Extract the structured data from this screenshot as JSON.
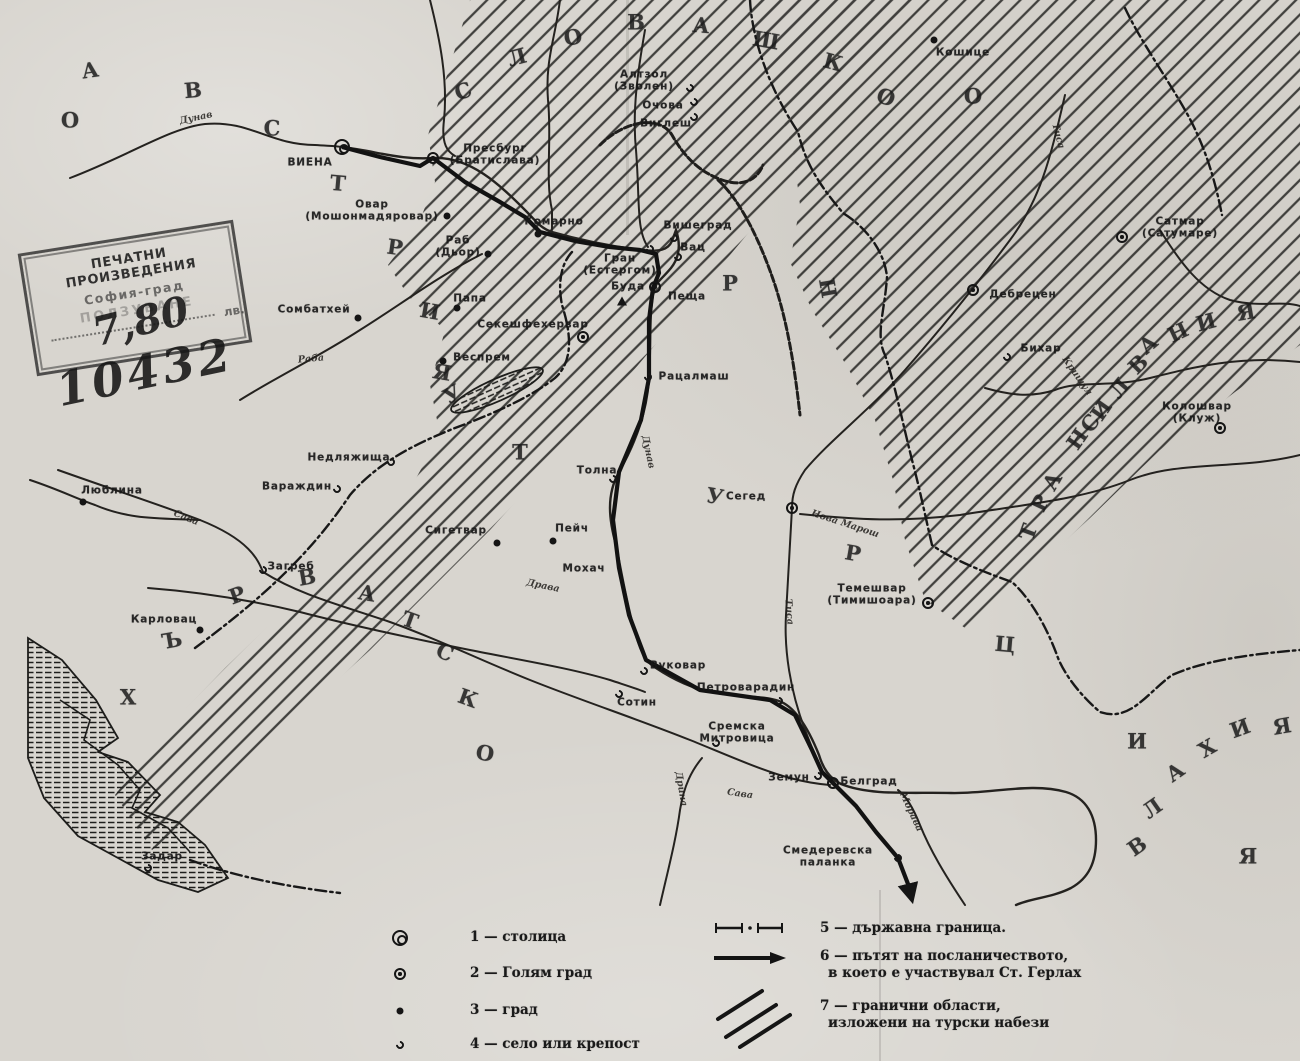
{
  "map": {
    "title_hint": "Historical map of Hungary and surrounding lands (Bulgarian, scanned)",
    "paper_color": "#d8d5cf",
    "ink_color": "#1b1b1b"
  },
  "stamp": {
    "line1": "ПЕЧАТНИ ПРОИЗВЕДЕНИЯ",
    "line2": "София-град",
    "line3": "ПОЛЗУВАНЕ",
    "currency": "лв.",
    "handwritten_price": "7,80",
    "handwritten_number": "10432"
  },
  "region_letters": [
    {
      "word": "австрия",
      "ch": "А",
      "x": 90,
      "y": 70,
      "r": -8
    },
    {
      "word": "австрия",
      "ch": "В",
      "x": 193,
      "y": 90,
      "r": -5
    },
    {
      "word": "австрия",
      "ch": "С",
      "x": 272,
      "y": 128,
      "r": 0
    },
    {
      "word": "австрия",
      "ch": "Т",
      "x": 338,
      "y": 183,
      "r": 5
    },
    {
      "word": "австрия",
      "ch": "Р",
      "x": 395,
      "y": 247,
      "r": 8
    },
    {
      "word": "австрия",
      "ch": "И",
      "x": 430,
      "y": 311,
      "r": 10
    },
    {
      "word": "австрия",
      "ch": "Я",
      "x": 442,
      "y": 372,
      "r": 10
    },
    {
      "word": "унгария",
      "ch": "У",
      "x": 452,
      "y": 394,
      "r": -30
    },
    {
      "word": "унгария",
      "ch": "Р",
      "x": 730,
      "y": 283,
      "r": 0
    },
    {
      "word": "унгария",
      "ch": "Н",
      "x": 828,
      "y": 288,
      "r": 80
    },
    {
      "word": "словашко",
      "ch": "С",
      "x": 463,
      "y": 91,
      "r": -20
    },
    {
      "word": "словашко",
      "ch": "Л",
      "x": 517,
      "y": 57,
      "r": -15
    },
    {
      "word": "словашко",
      "ch": "О",
      "x": 573,
      "y": 37,
      "r": -10
    },
    {
      "word": "словашко",
      "ch": "В",
      "x": 636,
      "y": 22,
      "r": 0
    },
    {
      "word": "словашко",
      "ch": "А",
      "x": 701,
      "y": 25,
      "r": 5
    },
    {
      "word": "словашко",
      "ch": "Ш",
      "x": 766,
      "y": 40,
      "r": 10
    },
    {
      "word": "словашко",
      "ch": "К",
      "x": 833,
      "y": 62,
      "r": 15
    },
    {
      "word": "словашко",
      "ch": "О",
      "x": 886,
      "y": 97,
      "r": 20
    },
    {
      "word": "словашко",
      "ch": "О",
      "x": 973,
      "y": 96,
      "r": 0
    },
    {
      "word": "мизия",
      "ch": "О",
      "x": 70,
      "y": 120,
      "r": 0
    },
    {
      "word": "турция",
      "ch": "Т",
      "x": 520,
      "y": 452,
      "r": 0
    },
    {
      "word": "турция",
      "ch": "У",
      "x": 715,
      "y": 496,
      "r": 10
    },
    {
      "word": "турция",
      "ch": "Р",
      "x": 853,
      "y": 553,
      "r": 10
    },
    {
      "word": "турция",
      "ch": "Ц",
      "x": 1005,
      "y": 644,
      "r": 5
    },
    {
      "word": "турция",
      "ch": "И",
      "x": 1137,
      "y": 741,
      "r": 0
    },
    {
      "word": "турция",
      "ch": "Я",
      "x": 1248,
      "y": 856,
      "r": 0
    },
    {
      "word": "трансилвания",
      "ch": "Т",
      "x": 1028,
      "y": 532,
      "r": -70
    },
    {
      "word": "трансилвания",
      "ch": "Р",
      "x": 1040,
      "y": 503,
      "r": -65
    },
    {
      "word": "трансилвания",
      "ch": "А",
      "x": 1052,
      "y": 481,
      "r": -60
    },
    {
      "word": "трансилвания",
      "ch": "Н",
      "x": 1077,
      "y": 439,
      "r": -55
    },
    {
      "word": "трансилвания",
      "ch": "С",
      "x": 1090,
      "y": 423,
      "r": -55
    },
    {
      "word": "трансилвания",
      "ch": "И",
      "x": 1101,
      "y": 410,
      "r": -55
    },
    {
      "word": "трансилвания",
      "ch": "Л",
      "x": 1119,
      "y": 388,
      "r": -50
    },
    {
      "word": "трансилвания",
      "ch": "В",
      "x": 1138,
      "y": 364,
      "r": -45
    },
    {
      "word": "трансилвания",
      "ch": "А",
      "x": 1148,
      "y": 344,
      "r": -40
    },
    {
      "word": "трансилвания",
      "ch": "Н",
      "x": 1178,
      "y": 332,
      "r": -25
    },
    {
      "word": "трансилвания",
      "ch": "И",
      "x": 1206,
      "y": 322,
      "r": -15
    },
    {
      "word": "трансилвания",
      "ch": "Я",
      "x": 1246,
      "y": 312,
      "r": -10
    },
    {
      "word": "хърватско",
      "ch": "Х",
      "x": 128,
      "y": 697,
      "r": 0
    },
    {
      "word": "хърватско",
      "ch": "Ъ",
      "x": 172,
      "y": 640,
      "r": -10
    },
    {
      "word": "хърватско",
      "ch": "Р",
      "x": 237,
      "y": 595,
      "r": -20
    },
    {
      "word": "хърватско",
      "ch": "В",
      "x": 307,
      "y": 577,
      "r": -10
    },
    {
      "word": "хърватско",
      "ch": "А",
      "x": 367,
      "y": 593,
      "r": 10
    },
    {
      "word": "хърватско",
      "ch": "Т",
      "x": 410,
      "y": 620,
      "r": 20
    },
    {
      "word": "хърватско",
      "ch": "С",
      "x": 445,
      "y": 652,
      "r": 25
    },
    {
      "word": "хърватско",
      "ch": "К",
      "x": 468,
      "y": 698,
      "r": 20
    },
    {
      "word": "хърватско",
      "ch": "О",
      "x": 485,
      "y": 753,
      "r": 10
    },
    {
      "word": "влахия",
      "ch": "В",
      "x": 1137,
      "y": 846,
      "r": -35
    },
    {
      "word": "влахия",
      "ch": "Л",
      "x": 1152,
      "y": 808,
      "r": -35
    },
    {
      "word": "влахия",
      "ch": "А",
      "x": 1175,
      "y": 772,
      "r": -35
    },
    {
      "word": "влахия",
      "ch": "Х",
      "x": 1207,
      "y": 748,
      "r": -30
    },
    {
      "word": "влахия",
      "ch": "И",
      "x": 1240,
      "y": 728,
      "r": -20
    },
    {
      "word": "влахия",
      "ch": "Я",
      "x": 1282,
      "y": 726,
      "r": -10
    }
  ],
  "cities": [
    {
      "label": [
        "ВИЕНА"
      ],
      "lx": 310,
      "ly": 163,
      "symbol": "capital",
      "sx": 342,
      "sy": 147
    },
    {
      "label": [
        "Пресбург",
        "(Братислава)"
      ],
      "lx": 495,
      "ly": 149,
      "symbol": "big",
      "sx": 433,
      "sy": 158
    },
    {
      "label": [
        "Овар",
        "(Мошонмадяровар)"
      ],
      "lx": 372,
      "ly": 205,
      "symbol": "town",
      "sx": 447,
      "sy": 216
    },
    {
      "label": [
        "Раб",
        "(Дьор)"
      ],
      "lx": 458,
      "ly": 241,
      "symbol": "town",
      "sx": 488,
      "sy": 254
    },
    {
      "label": [
        "Комарно"
      ],
      "lx": 554,
      "ly": 222,
      "symbol": "town",
      "sx": 538,
      "sy": 234
    },
    {
      "label": [
        "Гран",
        "(Естергом)"
      ],
      "lx": 620,
      "ly": 259,
      "symbol": "village",
      "sx": 650,
      "sy": 249
    },
    {
      "label": [
        "Вишеград"
      ],
      "lx": 698,
      "ly": 226,
      "symbol": "village",
      "sx": 674,
      "sy": 238
    },
    {
      "label": [
        "Вац"
      ],
      "lx": 693,
      "ly": 248,
      "symbol": "village",
      "sx": 678,
      "sy": 257
    },
    {
      "label": [
        "Буда"
      ],
      "lx": 628,
      "ly": 287,
      "symbol": "big",
      "sx": 655,
      "sy": 287
    },
    {
      "label": [
        "Пеща"
      ],
      "lx": 687,
      "ly": 297,
      "symbol": "triangle",
      "sx": 622,
      "sy": 301
    },
    {
      "label": [
        "Секешфехервар"
      ],
      "lx": 533,
      "ly": 325,
      "symbol": "big",
      "sx": 583,
      "sy": 337
    },
    {
      "label": [
        "Сомбатхей"
      ],
      "lx": 314,
      "ly": 310,
      "symbol": "town",
      "sx": 358,
      "sy": 318
    },
    {
      "label": [
        "Папа"
      ],
      "lx": 470,
      "ly": 299,
      "symbol": "town",
      "sx": 457,
      "sy": 308
    },
    {
      "label": [
        "Веспрем"
      ],
      "lx": 482,
      "ly": 358,
      "symbol": "town",
      "sx": 443,
      "sy": 361
    },
    {
      "label": [
        "Рацалмаш"
      ],
      "lx": 694,
      "ly": 377,
      "symbol": "village",
      "sx": 648,
      "sy": 377
    },
    {
      "label": [
        "Толна"
      ],
      "lx": 597,
      "ly": 471,
      "symbol": "village",
      "sx": 613,
      "sy": 479
    },
    {
      "label": [
        "Пейч"
      ],
      "lx": 572,
      "ly": 529,
      "symbol": "town",
      "sx": 553,
      "sy": 541
    },
    {
      "label": [
        "Мохач"
      ],
      "lx": 584,
      "ly": 569,
      "symbol": "",
      "sx": 0,
      "sy": 0
    },
    {
      "label": [
        "Сигетвар"
      ],
      "lx": 456,
      "ly": 531,
      "symbol": "town",
      "sx": 497,
      "sy": 543
    },
    {
      "label": [
        "Сегед"
      ],
      "lx": 746,
      "ly": 497,
      "symbol": "big",
      "sx": 792,
      "sy": 508
    },
    {
      "label": [
        "Темешвар",
        "(Тимишоара)"
      ],
      "lx": 872,
      "ly": 589,
      "symbol": "big",
      "sx": 928,
      "sy": 603
    },
    {
      "label": [
        "Вуковар"
      ],
      "lx": 678,
      "ly": 666,
      "symbol": "village",
      "sx": 644,
      "sy": 671
    },
    {
      "label": [
        "Сотин"
      ],
      "lx": 637,
      "ly": 703,
      "symbol": "village",
      "sx": 619,
      "sy": 694
    },
    {
      "label": [
        "Петроварадин"
      ],
      "lx": 746,
      "ly": 688,
      "symbol": "village",
      "sx": 779,
      "sy": 701
    },
    {
      "label": [
        "Сремска",
        "Митровица"
      ],
      "lx": 737,
      "ly": 727,
      "symbol": "village",
      "sx": 716,
      "sy": 743
    },
    {
      "label": [
        "Земун"
      ],
      "lx": 789,
      "ly": 778,
      "symbol": "village",
      "sx": 818,
      "sy": 776
    },
    {
      "label": [
        "Белград"
      ],
      "lx": 869,
      "ly": 782,
      "symbol": "big",
      "sx": 833,
      "sy": 783
    },
    {
      "label": [
        "Смедеревска",
        "паланка"
      ],
      "lx": 828,
      "ly": 851,
      "symbol": "village",
      "sx": 898,
      "sy": 858
    },
    {
      "label": [
        "Недляжища"
      ],
      "lx": 349,
      "ly": 458,
      "symbol": "village",
      "sx": 391,
      "sy": 462
    },
    {
      "label": [
        "Вараждин"
      ],
      "lx": 297,
      "ly": 487,
      "symbol": "village",
      "sx": 337,
      "sy": 489
    },
    {
      "label": [
        "Люблина"
      ],
      "lx": 112,
      "ly": 491,
      "symbol": "town",
      "sx": 83,
      "sy": 502
    },
    {
      "label": [
        "Загреб"
      ],
      "lx": 291,
      "ly": 567,
      "symbol": "village",
      "sx": 263,
      "sy": 570
    },
    {
      "label": [
        "Карловац"
      ],
      "lx": 164,
      "ly": 620,
      "symbol": "town",
      "sx": 200,
      "sy": 630
    },
    {
      "label": [
        "Кошице"
      ],
      "lx": 963,
      "ly": 53,
      "symbol": "town",
      "sx": 934,
      "sy": 40
    },
    {
      "label": [
        "Алтзол",
        "(Зволен)"
      ],
      "lx": 644,
      "ly": 75,
      "symbol": "village",
      "sx": 690,
      "sy": 88
    },
    {
      "label": [
        "Очова"
      ],
      "lx": 663,
      "ly": 106,
      "symbol": "village",
      "sx": 694,
      "sy": 102
    },
    {
      "label": [
        "Виглеш"
      ],
      "lx": 666,
      "ly": 124,
      "symbol": "village",
      "sx": 694,
      "sy": 117
    },
    {
      "label": [
        "Дебрецен"
      ],
      "lx": 1023,
      "ly": 295,
      "symbol": "big",
      "sx": 973,
      "sy": 290
    },
    {
      "label": [
        "Бихар"
      ],
      "lx": 1041,
      "ly": 349,
      "symbol": "village",
      "sx": 1007,
      "sy": 357
    },
    {
      "label": [
        "Колошвар",
        "(Клуж)"
      ],
      "lx": 1197,
      "ly": 407,
      "symbol": "big",
      "sx": 1220,
      "sy": 428
    },
    {
      "label": [
        "Сатмар",
        "(Сатумаре)"
      ],
      "lx": 1180,
      "ly": 222,
      "symbol": "big",
      "sx": 1122,
      "sy": 237
    },
    {
      "label": [
        "Задар"
      ],
      "lx": 162,
      "ly": 857,
      "symbol": "village",
      "sx": 148,
      "sy": 868
    }
  ],
  "river_labels": [
    {
      "name": "Дунав",
      "x": 196,
      "y": 118,
      "r": -12
    },
    {
      "name": "Дунав",
      "x": 648,
      "y": 452,
      "r": 78
    },
    {
      "name": "Тиса",
      "x": 1058,
      "y": 136,
      "r": 75
    },
    {
      "name": "Тиса",
      "x": 789,
      "y": 612,
      "r": 85
    },
    {
      "name": "Сава",
      "x": 186,
      "y": 518,
      "r": 22
    },
    {
      "name": "Сава",
      "x": 740,
      "y": 794,
      "r": 8
    },
    {
      "name": "Драва",
      "x": 543,
      "y": 586,
      "r": 12
    },
    {
      "name": "Дрина",
      "x": 681,
      "y": 789,
      "r": 80
    },
    {
      "name": "Морава",
      "x": 911,
      "y": 812,
      "r": 65
    },
    {
      "name": "Раба",
      "x": 311,
      "y": 359,
      "r": -5
    },
    {
      "name": "Нова Марош",
      "x": 845,
      "y": 524,
      "r": 18
    },
    {
      "name": "Кришул",
      "x": 1077,
      "y": 376,
      "r": 55
    }
  ],
  "legend": {
    "city_items": [
      {
        "label": "1 — столица",
        "symbol": "capital"
      },
      {
        "label": "2 — Голям град",
        "symbol": "big"
      },
      {
        "label": "3 — град",
        "symbol": "town"
      },
      {
        "label": "4 — село или крепост",
        "symbol": "village"
      }
    ],
    "line_items": [
      {
        "lines": [
          "5 — държавна граница."
        ],
        "sample": "border"
      },
      {
        "lines": [
          "6 — пътят на посланичеството,",
          "в което е участвувал Ст. Герлах"
        ],
        "sample": "route"
      },
      {
        "lines": [
          "7 — гранични области,",
          "изложени на турски набези"
        ],
        "sample": "hatch"
      }
    ]
  }
}
